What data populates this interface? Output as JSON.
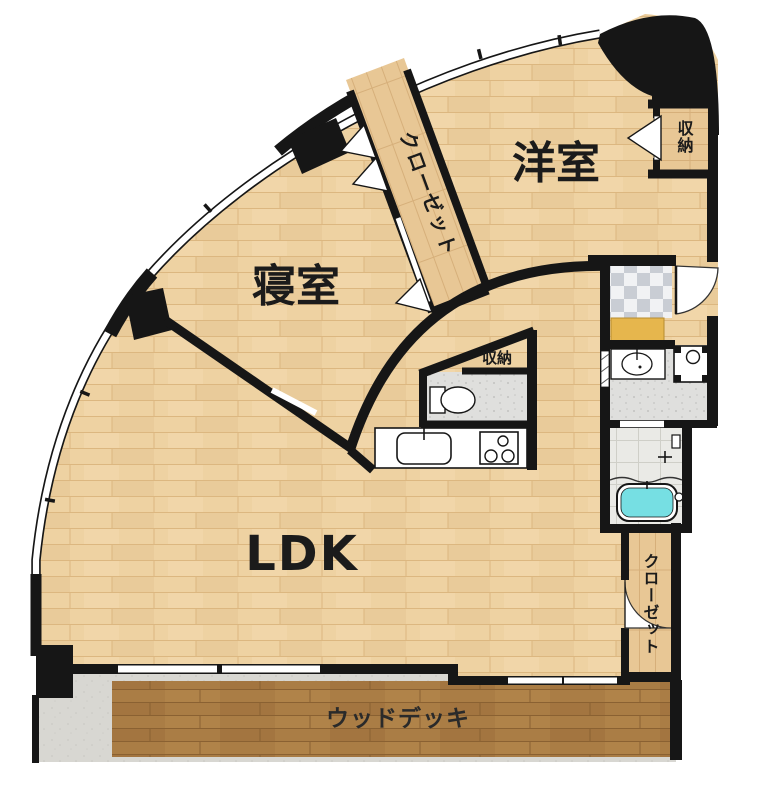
{
  "floorplan": {
    "rooms": {
      "western_room": {
        "label": "洋室"
      },
      "bedroom": {
        "label": "寝室"
      },
      "ldk": {
        "label": "LDK"
      },
      "wood_deck": {
        "label": "ウッドデッキ"
      }
    },
    "storages": {
      "closet_diagonal": {
        "label": "クローゼット"
      },
      "closet_bottom_right": {
        "label": "クローゼット"
      },
      "storage_western_room": {
        "label": "収納"
      },
      "storage_hall": {
        "label": "収納"
      }
    },
    "colors": {
      "wall": "#161616",
      "wood_floor": "#eed2a2",
      "deck_wood": "#aa7d45",
      "closet_wood": "#e8c795",
      "bathtub": "#76dfe3",
      "entrance_mat": "#e6b64d",
      "tile_gray": "#c9cdd4",
      "concrete": "#d8d7d2"
    }
  }
}
